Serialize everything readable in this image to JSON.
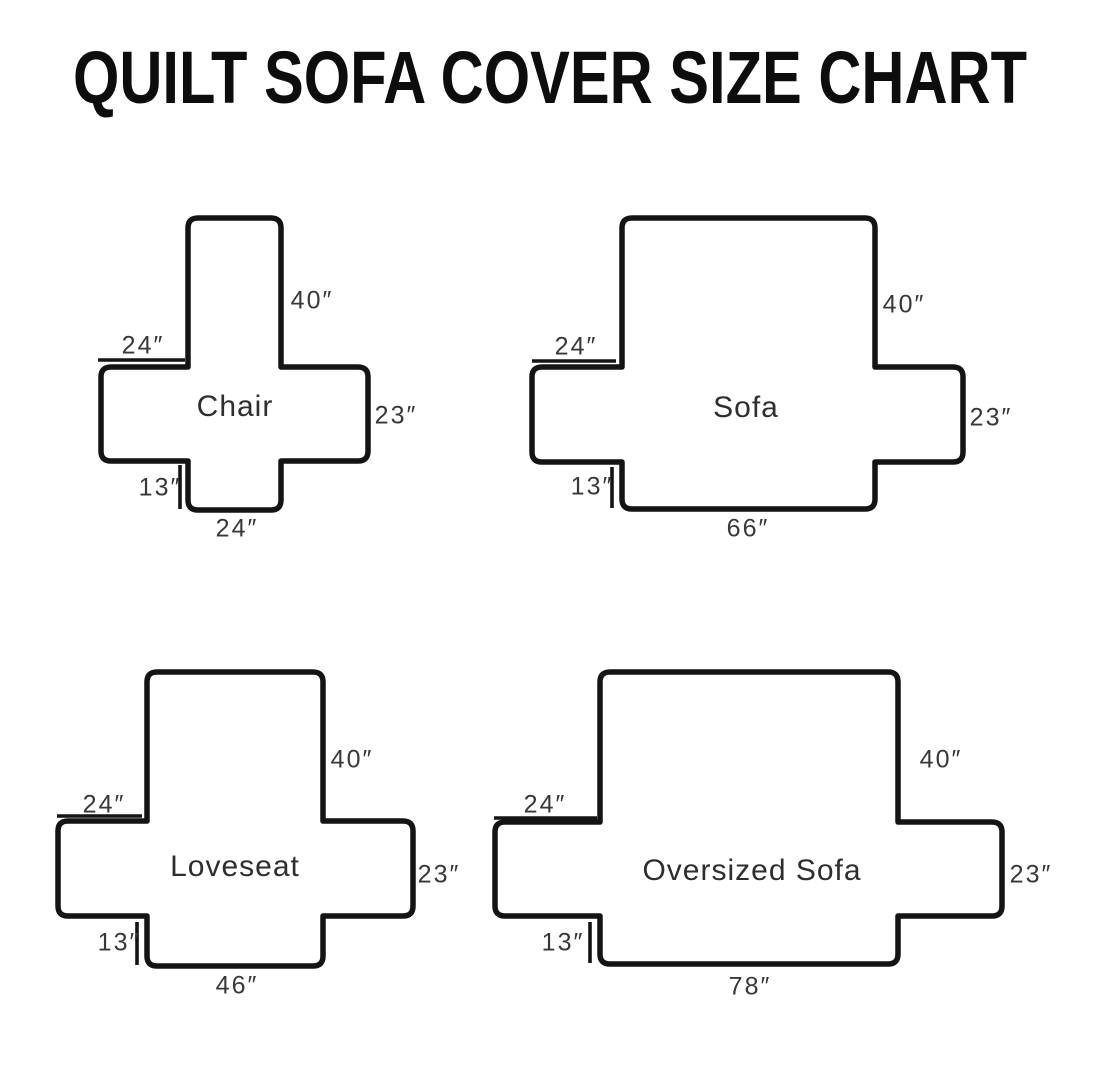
{
  "title": "QUILT SOFA COVER SIZE CHART",
  "colors": {
    "line": "#141414",
    "text": "#383838",
    "background": "#ffffff"
  },
  "diagrams": [
    {
      "name": "Chair",
      "back_height": "40″",
      "arm_top_width": "24″",
      "side_height": "23″",
      "front_drop": "13″",
      "base_width": "24″"
    },
    {
      "name": "Sofa",
      "back_height": "40″",
      "arm_top_width": "24″",
      "side_height": "23″",
      "front_drop": "13″",
      "base_width": "66″"
    },
    {
      "name": "Loveseat",
      "back_height": "40″",
      "arm_top_width": "24″",
      "side_height": "23″",
      "front_drop": "13″",
      "base_width": "46″"
    },
    {
      "name": "Oversized Sofa",
      "back_height": "40″",
      "arm_top_width": "24″",
      "side_height": "23″",
      "front_drop": "13″",
      "base_width": "78″"
    }
  ]
}
